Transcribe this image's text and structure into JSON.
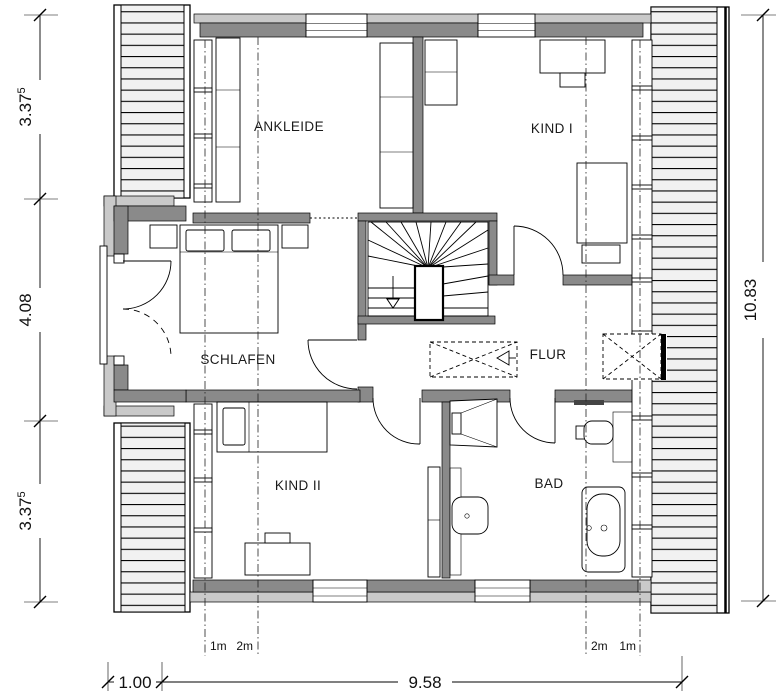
{
  "plan": {
    "room_labels": {
      "ankleide": "ANKLEIDE",
      "kind_i": "KIND I",
      "schlafen": "SCHLAFEN",
      "flur": "FLUR",
      "kind_ii": "KIND II",
      "bad": "BAD"
    },
    "dimensions": {
      "left": [
        {
          "main": "3.37",
          "sup": "5"
        },
        {
          "main": "4.08",
          "sup": ""
        },
        {
          "main": "3.37",
          "sup": "5"
        }
      ],
      "right": {
        "main": "10.83"
      },
      "bottom": [
        {
          "main": "1.00"
        },
        {
          "main": "9.58"
        }
      ],
      "roof_height_lines": [
        "1m",
        "2m",
        "2m",
        "1m"
      ]
    },
    "colors": {
      "wall_dark": "#8a8a8a",
      "band_light": "#c9c9c9",
      "hatch_bg": "#f1f1f1",
      "line": "#000000",
      "label_text": "#1a1a1a"
    },
    "symbols": {
      "stair_arrow": "down-direction-arrow",
      "skylight_box": "dashed-cross-rectangle",
      "roof_overhang": "horizontal-hatch-strip"
    }
  }
}
